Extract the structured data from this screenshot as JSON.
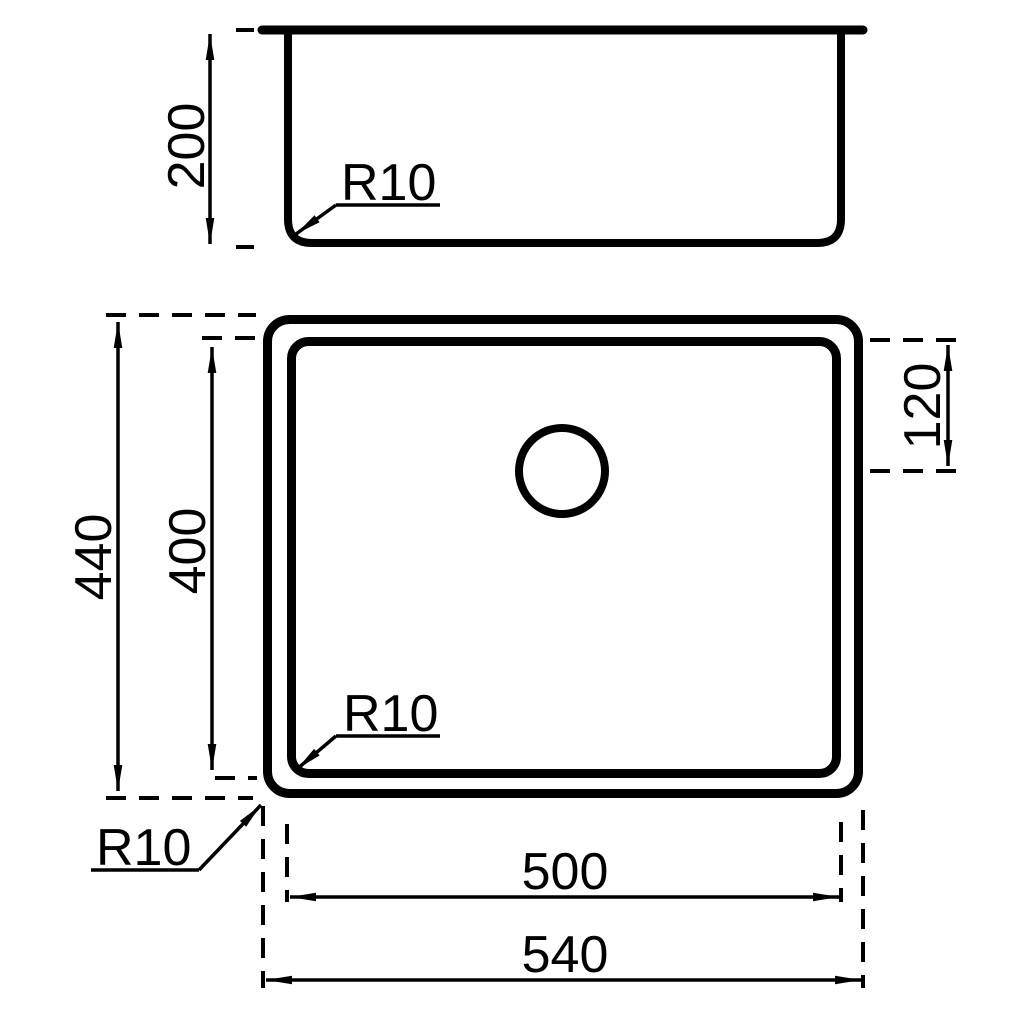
{
  "drawing": {
    "type": "technical-dimension-drawing",
    "background": "#ffffff",
    "line_color": "#000000",
    "labels": {
      "front_view": {
        "depth": "200",
        "bottom_radius": "R10"
      },
      "plan_view": {
        "outer_height": "440",
        "inner_height": "400",
        "drain_offset": "120",
        "inner_width": "500",
        "outer_width": "540",
        "inner_corner_radius": "R10",
        "outer_corner_radius": "R10"
      }
    }
  }
}
